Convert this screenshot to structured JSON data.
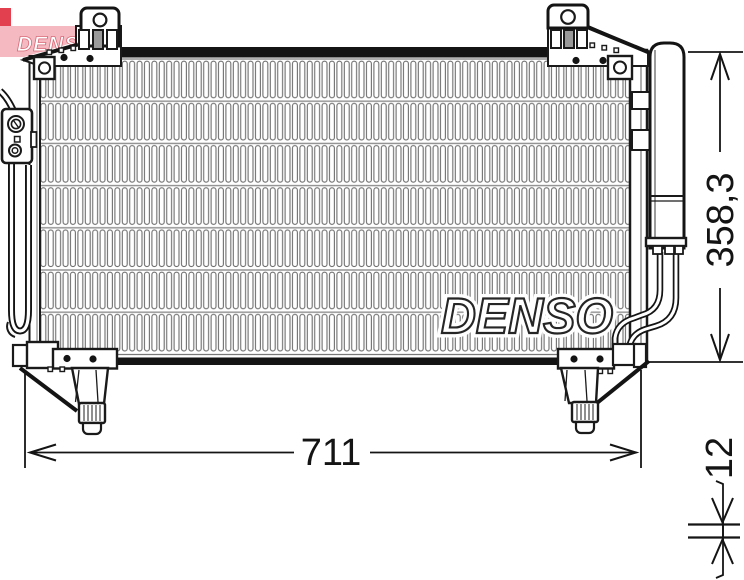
{
  "logo": {
    "text": "DENSO",
    "red": "#e2404e",
    "pink": "#f4b9c1"
  },
  "watermark": {
    "text": "DENSO"
  },
  "dimensions": {
    "width_label": "711",
    "height_label": "358,3",
    "depth_label": "12"
  },
  "colors": {
    "line": "#141414",
    "fin": "#6e6e6e",
    "fin_divider": "#8d8d8d"
  }
}
